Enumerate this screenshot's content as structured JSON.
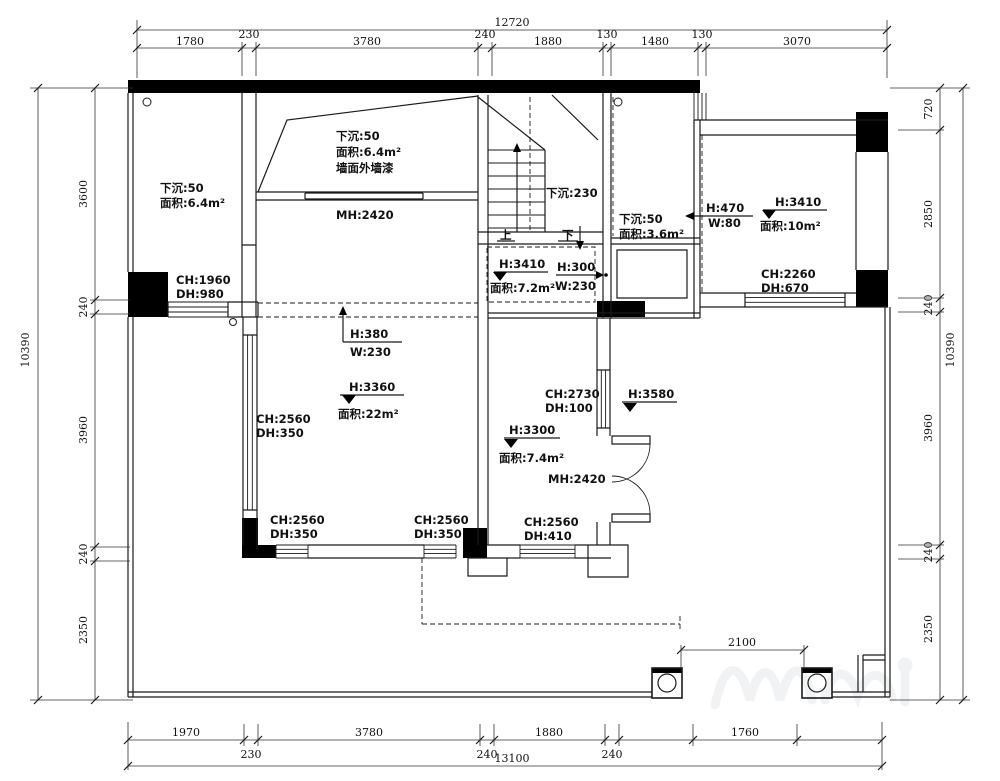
{
  "palette": {
    "ink": "#1a1a1a",
    "dimline": "#333333",
    "bg": "#ffffff"
  },
  "dims": {
    "top": {
      "total": "12720",
      "segments": [
        "1780",
        "230",
        "3780",
        "240",
        "1880",
        "130",
        "1480",
        "130",
        "3070"
      ]
    },
    "bottom": {
      "total": "13100",
      "segments": [
        "1970",
        "230",
        "3780",
        "240",
        "1880",
        "240",
        "1760"
      ]
    },
    "left": {
      "total": "10390",
      "segments": [
        "3600",
        "240",
        "3960",
        "240",
        "2350"
      ]
    },
    "right": {
      "total": "10390",
      "segments": [
        "720",
        "2850",
        "240",
        "3960",
        "240",
        "2350"
      ]
    },
    "columns": {
      "span": "2100"
    }
  },
  "rooms": {
    "storage_left": {
      "sunken": "下沉:50",
      "area": "面积:6.4m²",
      "ch": "CH:1960",
      "dh": "DH:980"
    },
    "upper_void": {
      "sunken": "下沉:50",
      "area": "面积:6.4m²",
      "finish": "墙面外墙漆",
      "mh": "MH:2420"
    },
    "stair": {
      "sunken": "下沉:230",
      "up": "上",
      "down": "下"
    },
    "storage_right": {
      "sunken": "下沉:50",
      "area": "面积:3.6m²"
    },
    "bedroom": {
      "h": "H:3410",
      "area": "面积:10m²",
      "niche_h": "H:470",
      "niche_w": "W:80",
      "ch": "CH:2260",
      "dh": "DH:670"
    },
    "hall": {
      "h": "H:3410",
      "area": "面积:7.2m²",
      "opening_h": "H:300",
      "opening_w": "W:230"
    },
    "living": {
      "h": "H:3360",
      "area": "面积:22m²",
      "opening_h": "H:380",
      "opening_w": "W:230",
      "ch_left": "CH:2560",
      "dh_left": "DH:350",
      "ch_bottom_left": "CH:2560",
      "dh_bottom_left": "DH:350",
      "ch_bottom_right": "CH:2560",
      "dh_bottom_right": "DH:350"
    },
    "kitchen": {
      "h": "H:3300",
      "area": "面积:7.4m²",
      "ch_top": "CH:2730",
      "dh_top": "DH:100",
      "mh": "MH:2420",
      "ch_bottom": "CH:2560",
      "dh_bottom": "DH:410"
    },
    "terrace": {
      "h": "H:3580"
    }
  }
}
